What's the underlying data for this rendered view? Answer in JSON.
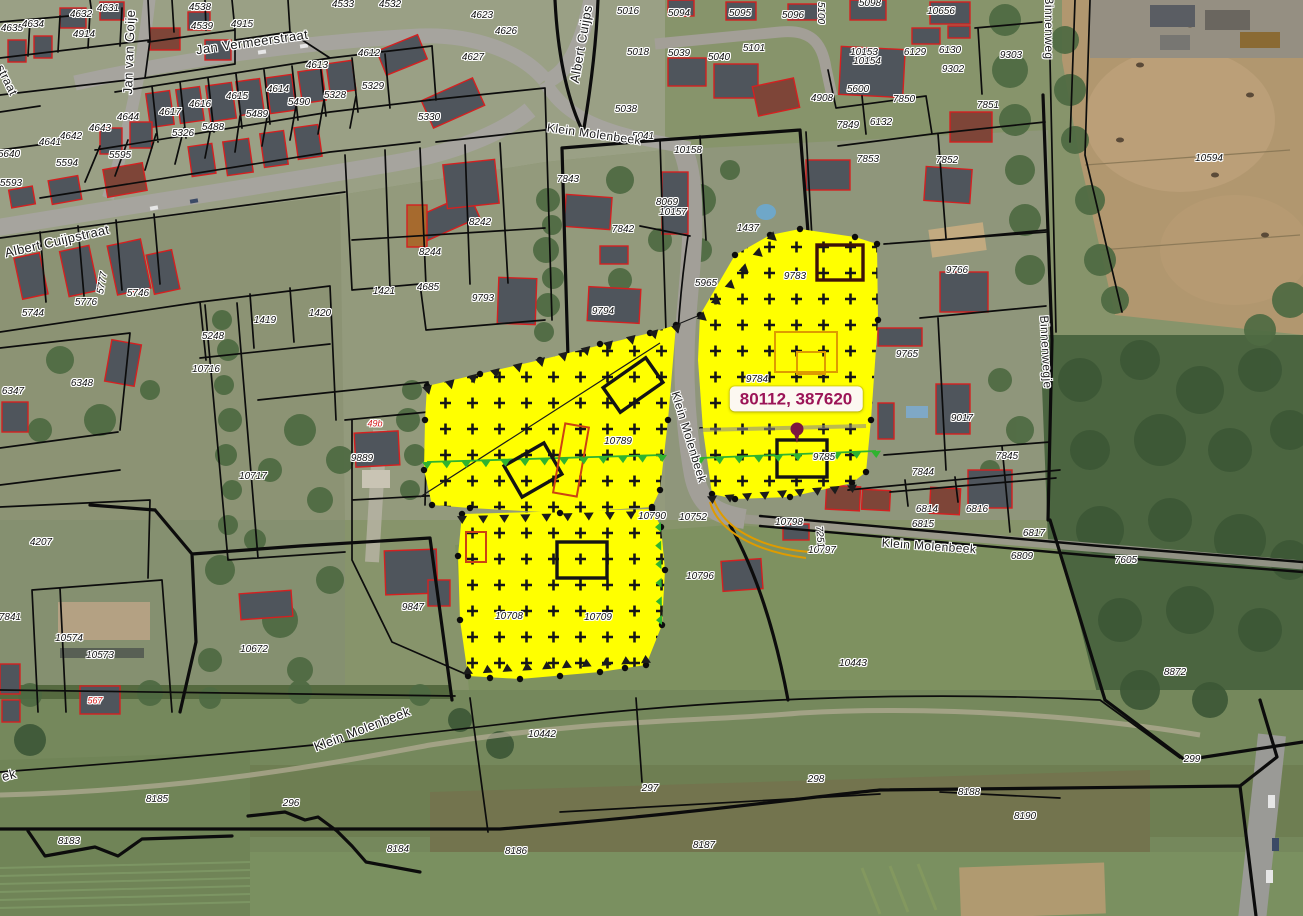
{
  "map": {
    "tooltip": {
      "text": "80112, 387620"
    },
    "colors": {
      "selection-yellow": "#ffff00",
      "cross": "#161616",
      "parcel-line": "#0c0c0c",
      "building-outline": "#d42020",
      "tooltip-text": "#9b1457",
      "tooltip-bg": "#fcf8f1",
      "marker": "#7c1740",
      "green-line": "#2fb32f",
      "orange-line": "#de9b00",
      "label-text": "#101010",
      "street-text": "#1c1c1c",
      "halo": "#ffffff"
    },
    "street_labels": [
      {
        "t": "Jan Vermeerstraat",
        "x": 252,
        "y": 42,
        "r": -8,
        "s": 13
      },
      {
        "t": "Jan van Goije",
        "x": 129,
        "y": 52,
        "r": -88,
        "s": 13
      },
      {
        "t": "straat",
        "x": 7,
        "y": 80,
        "r": 64,
        "s": 12
      },
      {
        "t": "Albert Cuijps",
        "x": 581,
        "y": 44,
        "r": -80,
        "s": 13
      },
      {
        "t": "Klein Molenbeek",
        "x": 594,
        "y": 134,
        "r": 8,
        "s": 12
      },
      {
        "t": "Albert Cuijpstraat",
        "x": 57,
        "y": 241,
        "r": -13,
        "s": 13
      },
      {
        "t": "Klein Molenbeek",
        "x": 689,
        "y": 437,
        "r": 73,
        "s": 12
      },
      {
        "t": "Klein Molenbeek",
        "x": 929,
        "y": 546,
        "r": 4,
        "s": 12
      },
      {
        "t": "Klein Molenbeek",
        "x": 362,
        "y": 729,
        "r": -21,
        "s": 13
      },
      {
        "t": "ek",
        "x": 9,
        "y": 775,
        "r": -15,
        "s": 13
      },
      {
        "t": "Binnenweg",
        "x": 1049,
        "y": 28,
        "r": 90,
        "s": 12
      },
      {
        "t": "Binnenwegje",
        "x": 1046,
        "y": 352,
        "r": 87,
        "s": 12
      }
    ],
    "parcel_labels": [
      {
        "t": "4631",
        "x": 108,
        "y": 9
      },
      {
        "t": "4632",
        "x": 81,
        "y": 15
      },
      {
        "t": "4538",
        "x": 200,
        "y": 8
      },
      {
        "t": "4539",
        "x": 202,
        "y": 27
      },
      {
        "t": "4635",
        "x": 12,
        "y": 29
      },
      {
        "t": "4634",
        "x": 33,
        "y": 25
      },
      {
        "t": "4914",
        "x": 84,
        "y": 35
      },
      {
        "t": "4915",
        "x": 242,
        "y": 25
      },
      {
        "t": "4613",
        "x": 317,
        "y": 66
      },
      {
        "t": "4617",
        "x": 170,
        "y": 113
      },
      {
        "t": "4616",
        "x": 200,
        "y": 105
      },
      {
        "t": "4615",
        "x": 237,
        "y": 97
      },
      {
        "t": "4614",
        "x": 278,
        "y": 90
      },
      {
        "t": "5490",
        "x": 299,
        "y": 103
      },
      {
        "t": "5489",
        "x": 257,
        "y": 115
      },
      {
        "t": "5488",
        "x": 213,
        "y": 128
      },
      {
        "t": "5326",
        "x": 183,
        "y": 134
      },
      {
        "t": "4644",
        "x": 128,
        "y": 118
      },
      {
        "t": "4643",
        "x": 100,
        "y": 129
      },
      {
        "t": "4642",
        "x": 71,
        "y": 137
      },
      {
        "t": "4641",
        "x": 50,
        "y": 143
      },
      {
        "t": "5640",
        "x": 9,
        "y": 155
      },
      {
        "t": "5595",
        "x": 120,
        "y": 156
      },
      {
        "t": "5594",
        "x": 67,
        "y": 164
      },
      {
        "t": "5593",
        "x": 11,
        "y": 184
      },
      {
        "t": "5744",
        "x": 33,
        "y": 314
      },
      {
        "t": "5776",
        "x": 86,
        "y": 303
      },
      {
        "t": "5777",
        "x": 103,
        "y": 283,
        "r": -80
      },
      {
        "t": "5746",
        "x": 138,
        "y": 294
      },
      {
        "t": "1419",
        "x": 265,
        "y": 321
      },
      {
        "t": "1420",
        "x": 320,
        "y": 314
      },
      {
        "t": "4533",
        "x": 343,
        "y": 5
      },
      {
        "t": "4532",
        "x": 390,
        "y": 5
      },
      {
        "t": "4623",
        "x": 482,
        "y": 16
      },
      {
        "t": "4626",
        "x": 506,
        "y": 32
      },
      {
        "t": "4627",
        "x": 473,
        "y": 58
      },
      {
        "t": "4612",
        "x": 369,
        "y": 54
      },
      {
        "t": "5329",
        "x": 373,
        "y": 87
      },
      {
        "t": "5328",
        "x": 335,
        "y": 96
      },
      {
        "t": "5330",
        "x": 429,
        "y": 118
      },
      {
        "t": "5016",
        "x": 628,
        "y": 12
      },
      {
        "t": "5018",
        "x": 638,
        "y": 53
      },
      {
        "t": "5038",
        "x": 626,
        "y": 110
      },
      {
        "t": "5041",
        "x": 643,
        "y": 137
      },
      {
        "t": "5094",
        "x": 679,
        "y": 14
      },
      {
        "t": "5095",
        "x": 740,
        "y": 14
      },
      {
        "t": "5096",
        "x": 793,
        "y": 16
      },
      {
        "t": "5098",
        "x": 870,
        "y": 4
      },
      {
        "t": "10656",
        "x": 941,
        "y": 12
      },
      {
        "t": "5100",
        "x": 820,
        "y": 13,
        "r": 90
      },
      {
        "t": "5039",
        "x": 679,
        "y": 54
      },
      {
        "t": "5040",
        "x": 719,
        "y": 58
      },
      {
        "t": "5101",
        "x": 754,
        "y": 49
      },
      {
        "t": "10153",
        "x": 864,
        "y": 53
      },
      {
        "t": "10154",
        "x": 867,
        "y": 62
      },
      {
        "t": "6129",
        "x": 915,
        "y": 53
      },
      {
        "t": "6130",
        "x": 950,
        "y": 51
      },
      {
        "t": "9302",
        "x": 953,
        "y": 70
      },
      {
        "t": "5600",
        "x": 858,
        "y": 90
      },
      {
        "t": "4908",
        "x": 822,
        "y": 99
      },
      {
        "t": "7850",
        "x": 904,
        "y": 100
      },
      {
        "t": "7849",
        "x": 848,
        "y": 126
      },
      {
        "t": "6132",
        "x": 881,
        "y": 123
      },
      {
        "t": "7851",
        "x": 988,
        "y": 106
      },
      {
        "t": "9303",
        "x": 1011,
        "y": 56
      },
      {
        "t": "10594",
        "x": 1209,
        "y": 159
      },
      {
        "t": "10158",
        "x": 688,
        "y": 151
      },
      {
        "t": "7853",
        "x": 868,
        "y": 160
      },
      {
        "t": "7852",
        "x": 947,
        "y": 161
      },
      {
        "t": "8069",
        "x": 667,
        "y": 203
      },
      {
        "t": "10157",
        "x": 673,
        "y": 213
      },
      {
        "t": "1437",
        "x": 748,
        "y": 229
      },
      {
        "t": "5965",
        "x": 706,
        "y": 284
      },
      {
        "t": "9783",
        "x": 795,
        "y": 277
      },
      {
        "t": "9766",
        "x": 957,
        "y": 271
      },
      {
        "t": "8242",
        "x": 480,
        "y": 223
      },
      {
        "t": "8244",
        "x": 430,
        "y": 253
      },
      {
        "t": "1421",
        "x": 384,
        "y": 292
      },
      {
        "t": "4685",
        "x": 428,
        "y": 288
      },
      {
        "t": "9793",
        "x": 483,
        "y": 299
      },
      {
        "t": "9794",
        "x": 603,
        "y": 312
      },
      {
        "t": "7843",
        "x": 568,
        "y": 180
      },
      {
        "t": "7842",
        "x": 623,
        "y": 230
      },
      {
        "t": "6347",
        "x": 13,
        "y": 392
      },
      {
        "t": "6348",
        "x": 82,
        "y": 384
      },
      {
        "t": "5248",
        "x": 213,
        "y": 337
      },
      {
        "t": "10716",
        "x": 206,
        "y": 370
      },
      {
        "t": "10717",
        "x": 253,
        "y": 477
      },
      {
        "t": "9889",
        "x": 362,
        "y": 459
      },
      {
        "t": "10789",
        "x": 618,
        "y": 442
      },
      {
        "t": "9765",
        "x": 907,
        "y": 355
      },
      {
        "t": "9017",
        "x": 962,
        "y": 419
      },
      {
        "t": "7844",
        "x": 923,
        "y": 473
      },
      {
        "t": "9785",
        "x": 824,
        "y": 458
      },
      {
        "t": "9784",
        "x": 757,
        "y": 380
      },
      {
        "t": "4207",
        "x": 41,
        "y": 543
      },
      {
        "t": "7841",
        "x": 10,
        "y": 618
      },
      {
        "t": "10574",
        "x": 69,
        "y": 639
      },
      {
        "t": "10573",
        "x": 100,
        "y": 656
      },
      {
        "t": "10672",
        "x": 254,
        "y": 650
      },
      {
        "t": "9847",
        "x": 413,
        "y": 608
      },
      {
        "t": "10708",
        "x": 509,
        "y": 617
      },
      {
        "t": "10709",
        "x": 598,
        "y": 618
      },
      {
        "t": "10790",
        "x": 652,
        "y": 517
      },
      {
        "t": "10752",
        "x": 693,
        "y": 518
      },
      {
        "t": "10798",
        "x": 789,
        "y": 523
      },
      {
        "t": "10797",
        "x": 822,
        "y": 551
      },
      {
        "t": "10796",
        "x": 700,
        "y": 577
      },
      {
        "t": "6814",
        "x": 927,
        "y": 510
      },
      {
        "t": "6815",
        "x": 923,
        "y": 525
      },
      {
        "t": "6816",
        "x": 977,
        "y": 510
      },
      {
        "t": "10443",
        "x": 853,
        "y": 664
      },
      {
        "t": "7251",
        "x": 819,
        "y": 537,
        "r": 85
      },
      {
        "t": "7845",
        "x": 1007,
        "y": 457
      },
      {
        "t": "6817",
        "x": 1034,
        "y": 534
      },
      {
        "t": "6809",
        "x": 1022,
        "y": 557
      },
      {
        "t": "7605",
        "x": 1126,
        "y": 561
      },
      {
        "t": "8872",
        "x": 1175,
        "y": 673
      },
      {
        "t": "10442",
        "x": 542,
        "y": 735
      },
      {
        "t": "8185",
        "x": 157,
        "y": 800
      },
      {
        "t": "296",
        "x": 291,
        "y": 804
      },
      {
        "t": "8183",
        "x": 69,
        "y": 842
      },
      {
        "t": "8184",
        "x": 398,
        "y": 850
      },
      {
        "t": "297",
        "x": 650,
        "y": 789
      },
      {
        "t": "298",
        "x": 816,
        "y": 780
      },
      {
        "t": "8186",
        "x": 516,
        "y": 852
      },
      {
        "t": "8187",
        "x": 704,
        "y": 846
      },
      {
        "t": "8188",
        "x": 969,
        "y": 793
      },
      {
        "t": "8190",
        "x": 1025,
        "y": 817
      },
      {
        "t": "299",
        "x": 1192,
        "y": 760
      }
    ],
    "building_labels": [
      {
        "t": "49b",
        "x": 375,
        "y": 424
      },
      {
        "t": "567",
        "x": 95,
        "y": 701
      }
    ]
  }
}
